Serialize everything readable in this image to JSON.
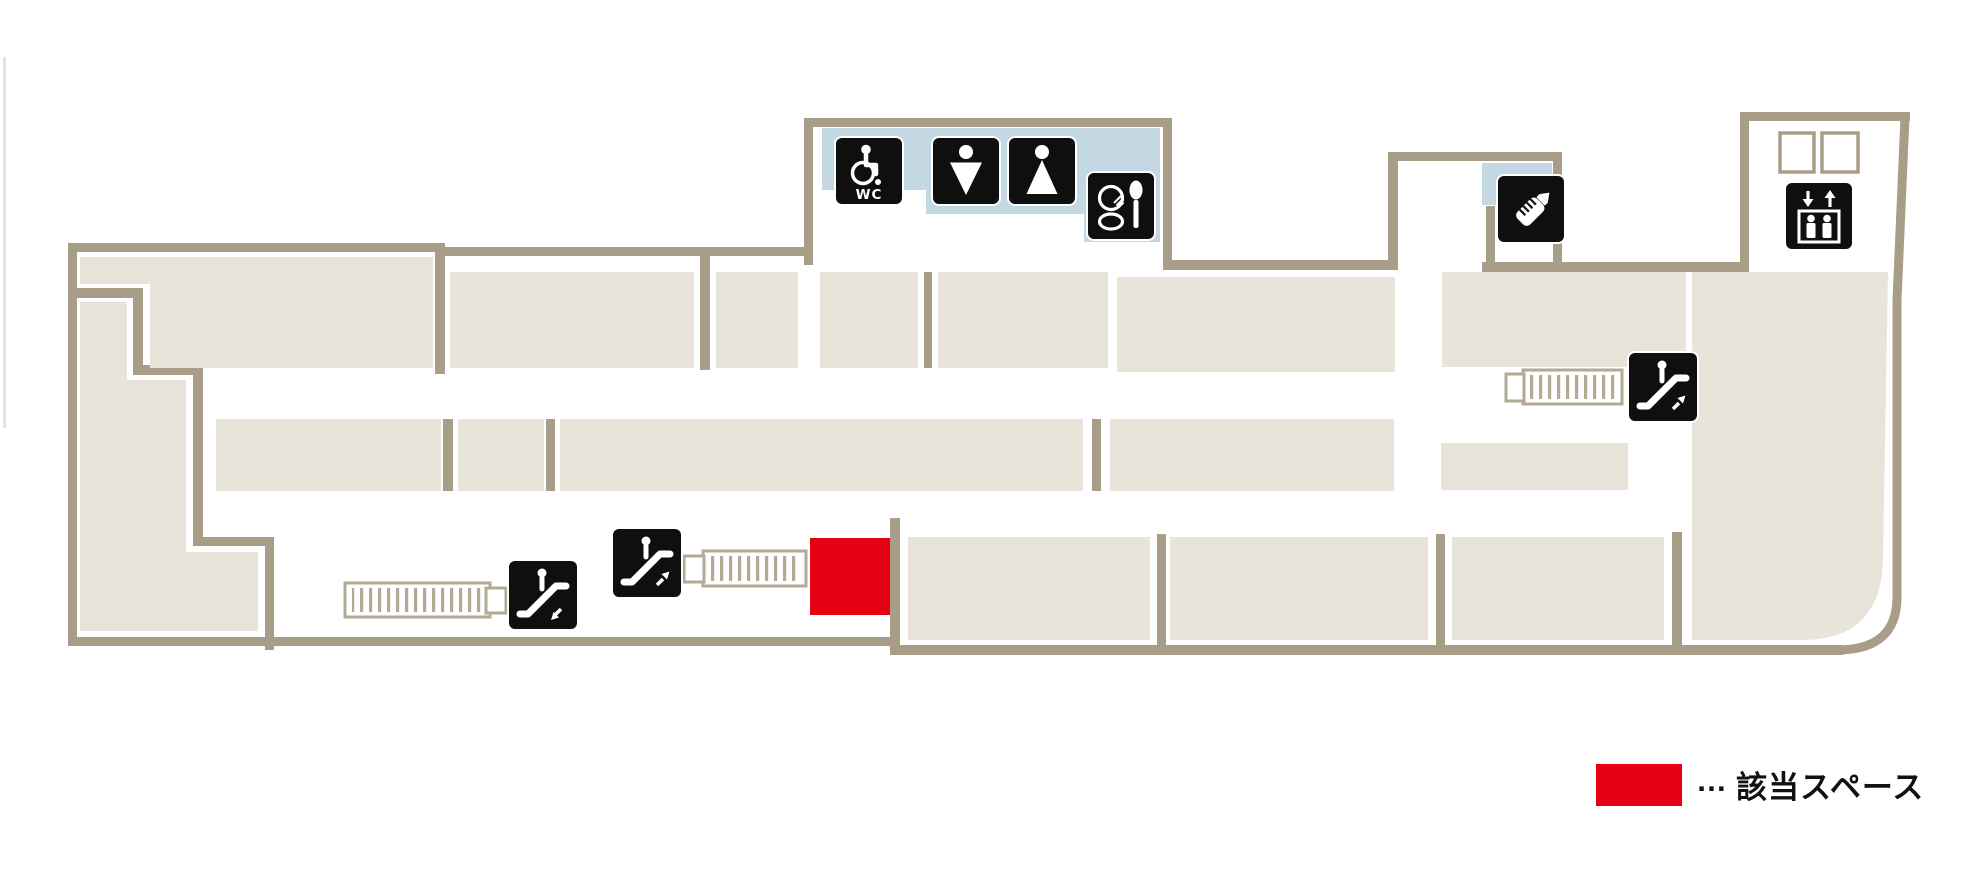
{
  "map": {
    "wc_label": "WC",
    "colors": {
      "wall": "#a89e88",
      "store_block": "#e8e4d9",
      "toilet_highlight": "#c3d8e2",
      "icon_background": "#0f0f0f",
      "target_red": "#e60013"
    },
    "facilities": [
      {
        "id": "wheelchair-accessible-toilet",
        "icon": "wheelchair-wc-icon",
        "label": "WC"
      },
      {
        "id": "mens-toilet",
        "icon": "man-icon"
      },
      {
        "id": "womens-toilet",
        "icon": "woman-icon"
      },
      {
        "id": "powder-corner",
        "icon": "cosmetics-icon"
      },
      {
        "id": "nursing-room",
        "icon": "baby-bottle-icon"
      },
      {
        "id": "elevator",
        "icon": "elevator-icon"
      },
      {
        "id": "escalator-down",
        "icon": "escalator-down-icon"
      },
      {
        "id": "escalator-up-center",
        "icon": "escalator-up-icon"
      },
      {
        "id": "escalator-up-right",
        "icon": "escalator-up-icon"
      }
    ]
  },
  "legend": {
    "ellipsis": "…",
    "label": "該当スペース",
    "swatch_color": "#e60013"
  }
}
